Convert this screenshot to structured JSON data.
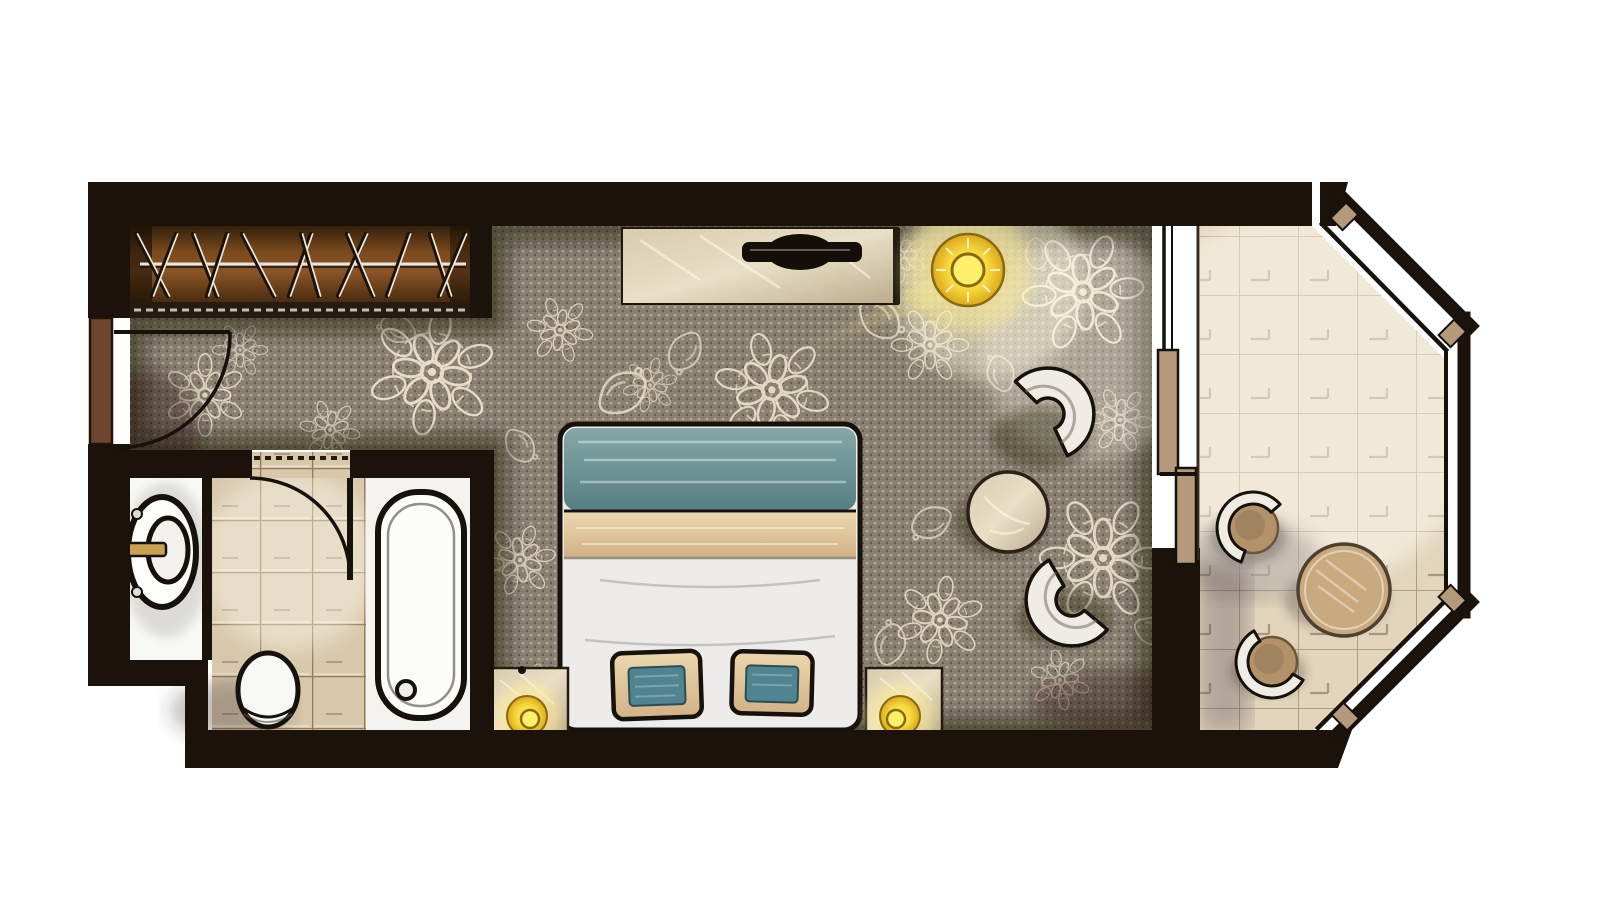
{
  "document": {
    "kind": "floor-plan-illustration",
    "subject": "hotel guest room, top-down rendered plan",
    "visible_text": []
  },
  "colors": {
    "paper": "#ffffff",
    "wall": "#1a120b",
    "outline": "#17110b",
    "carpet_base": "#8b8172",
    "carpet_lace": "#ece2cc",
    "wood_dark": "#3b2209",
    "wood_mid": "#7c4a1d",
    "wood_light": "#9a6228",
    "rail_metal": "#e6e6e6",
    "tile_bath": "#d8c7ab",
    "tile_grout": "#8a6f52",
    "tile_balcony": "#e2d5bc",
    "balcony_grout": "#9b8668",
    "porcelain": "#f8f8f6",
    "tub_white": "#f4f3f0",
    "bed_teal_a": "#86a8a7",
    "bed_teal_b": "#567e83",
    "bed_tan_a": "#ecd7ad",
    "bed_tan_b": "#d2b286",
    "bed_white": "#edecea",
    "pillow_teal": "#4f8490",
    "marble_a": "#d8cbaf",
    "marble_b": "#bcab8c",
    "lamp_core": "#fdf06a",
    "lamp_mid": "#f6d93e",
    "lamp_rim": "#dca81a",
    "lamp_ring": "#8a6a10",
    "door_brown": "#6e4630",
    "glass_tan": "#b49a7a",
    "chair_white": "#efece5",
    "balcony_wood": "#b3926a",
    "balcony_wood_dark": "#6d5438",
    "faucet_brass": "#caa24f"
  },
  "rooms": [
    {
      "id": "entry-hall",
      "features": [
        "entry-door",
        "door-swing-arc",
        "lace-carpet"
      ]
    },
    {
      "id": "closet",
      "features": [
        "hanging-rail",
        "clothes-hangers",
        "sliding-track"
      ]
    },
    {
      "id": "bathroom",
      "features": [
        "washbasin-counter",
        "round-basin",
        "faucet",
        "toilet",
        "bathtub",
        "tiled-floor",
        "door-swing-arc"
      ]
    },
    {
      "id": "bedroom",
      "features": [
        "double-bed",
        "decorative-pillows",
        "nightstand-left",
        "nightstand-right",
        "table-lamps",
        "tv-console",
        "tv",
        "ceiling-lamp",
        "lounge-chair-upper",
        "lounge-chair-lower",
        "pouf-table",
        "lace-carpet"
      ]
    },
    {
      "id": "balcony",
      "features": [
        "bay-windows",
        "sliding-glass-door",
        "tiled-floor",
        "bistro-table",
        "balcony-chair-upper",
        "balcony-chair-lower"
      ]
    }
  ],
  "closet": {
    "hangers": [
      {
        "x": 152,
        "dx": -16
      },
      {
        "x": 164,
        "dx": 12
      },
      {
        "x": 205,
        "dx": -12
      },
      {
        "x": 217,
        "dx": 10
      },
      {
        "x": 258,
        "dx": -16
      },
      {
        "x": 300,
        "dx": 11
      },
      {
        "x": 310,
        "dx": -9
      },
      {
        "x": 352,
        "dx": 14
      },
      {
        "x": 360,
        "dx": -13
      },
      {
        "x": 398,
        "dx": 11
      },
      {
        "x": 440,
        "dx": -10
      },
      {
        "x": 452,
        "dx": 13
      }
    ]
  },
  "carpet": {
    "motifs": [
      {
        "k": "flower",
        "x": 432,
        "y": 372,
        "s": 1.15,
        "r": 10,
        "o": 0.95
      },
      {
        "k": "flower",
        "x": 772,
        "y": 390,
        "s": 1.05,
        "r": -15,
        "o": 0.9
      },
      {
        "k": "flower",
        "x": 1083,
        "y": 292,
        "s": 1.1,
        "r": 25,
        "o": 0.95
      },
      {
        "k": "flower",
        "x": 1103,
        "y": 558,
        "s": 1.15,
        "r": -30,
        "o": 0.9
      },
      {
        "k": "flower",
        "x": 205,
        "y": 395,
        "s": 0.75,
        "r": 0,
        "o": 0.85
      },
      {
        "k": "flower",
        "x": 330,
        "y": 430,
        "s": 0.55,
        "r": 40,
        "o": 0.8
      },
      {
        "k": "flower",
        "x": 560,
        "y": 330,
        "s": 0.6,
        "r": -20,
        "o": 0.8
      },
      {
        "k": "flower",
        "x": 650,
        "y": 385,
        "s": 0.5,
        "r": 15,
        "o": 0.7
      },
      {
        "k": "flower",
        "x": 930,
        "y": 345,
        "s": 0.7,
        "r": 30,
        "o": 0.8
      },
      {
        "k": "flower",
        "x": 520,
        "y": 560,
        "s": 0.65,
        "r": -40,
        "o": 0.8
      },
      {
        "k": "flower",
        "x": 940,
        "y": 620,
        "s": 0.8,
        "r": 10,
        "o": 0.85
      },
      {
        "k": "flower",
        "x": 1120,
        "y": 420,
        "s": 0.6,
        "r": -25,
        "o": 0.75
      },
      {
        "k": "flower",
        "x": 530,
        "y": 690,
        "s": 0.5,
        "r": 20,
        "o": 0.7
      },
      {
        "k": "flower",
        "x": 1060,
        "y": 680,
        "s": 0.55,
        "r": -10,
        "o": 0.7
      },
      {
        "k": "flower",
        "x": 240,
        "y": 350,
        "s": 0.5,
        "r": -30,
        "o": 0.7
      },
      {
        "k": "flower",
        "x": 900,
        "y": 255,
        "s": 0.5,
        "r": 0,
        "o": 0.6
      },
      {
        "k": "paisley",
        "x": 600,
        "y": 400,
        "s": 1,
        "r": -20,
        "o": 0.8
      },
      {
        "k": "paisley",
        "x": 700,
        "y": 340,
        "s": 0.8,
        "r": 140,
        "o": 0.7
      },
      {
        "k": "paisley",
        "x": 870,
        "y": 300,
        "s": 0.9,
        "r": 60,
        "o": 0.75
      },
      {
        "k": "paisley",
        "x": 1000,
        "y": 390,
        "s": 0.7,
        "r": -90,
        "o": 0.7
      },
      {
        "k": "paisley",
        "x": 950,
        "y": 520,
        "s": 0.8,
        "r": 170,
        "o": 0.7
      },
      {
        "k": "paisley",
        "x": 1140,
        "y": 620,
        "s": 0.7,
        "r": 40,
        "o": 0.7
      },
      {
        "k": "paisley",
        "x": 410,
        "y": 340,
        "s": 0.7,
        "r": -140,
        "o": 0.7
      },
      {
        "k": "paisley",
        "x": 880,
        "y": 660,
        "s": 0.8,
        "r": -60,
        "o": 0.7
      },
      {
        "k": "paisley",
        "x": 1040,
        "y": 240,
        "s": 0.6,
        "r": 100,
        "o": 0.6
      },
      {
        "k": "paisley",
        "x": 515,
        "y": 430,
        "s": 0.7,
        "r": 70,
        "o": 0.7
      }
    ]
  }
}
